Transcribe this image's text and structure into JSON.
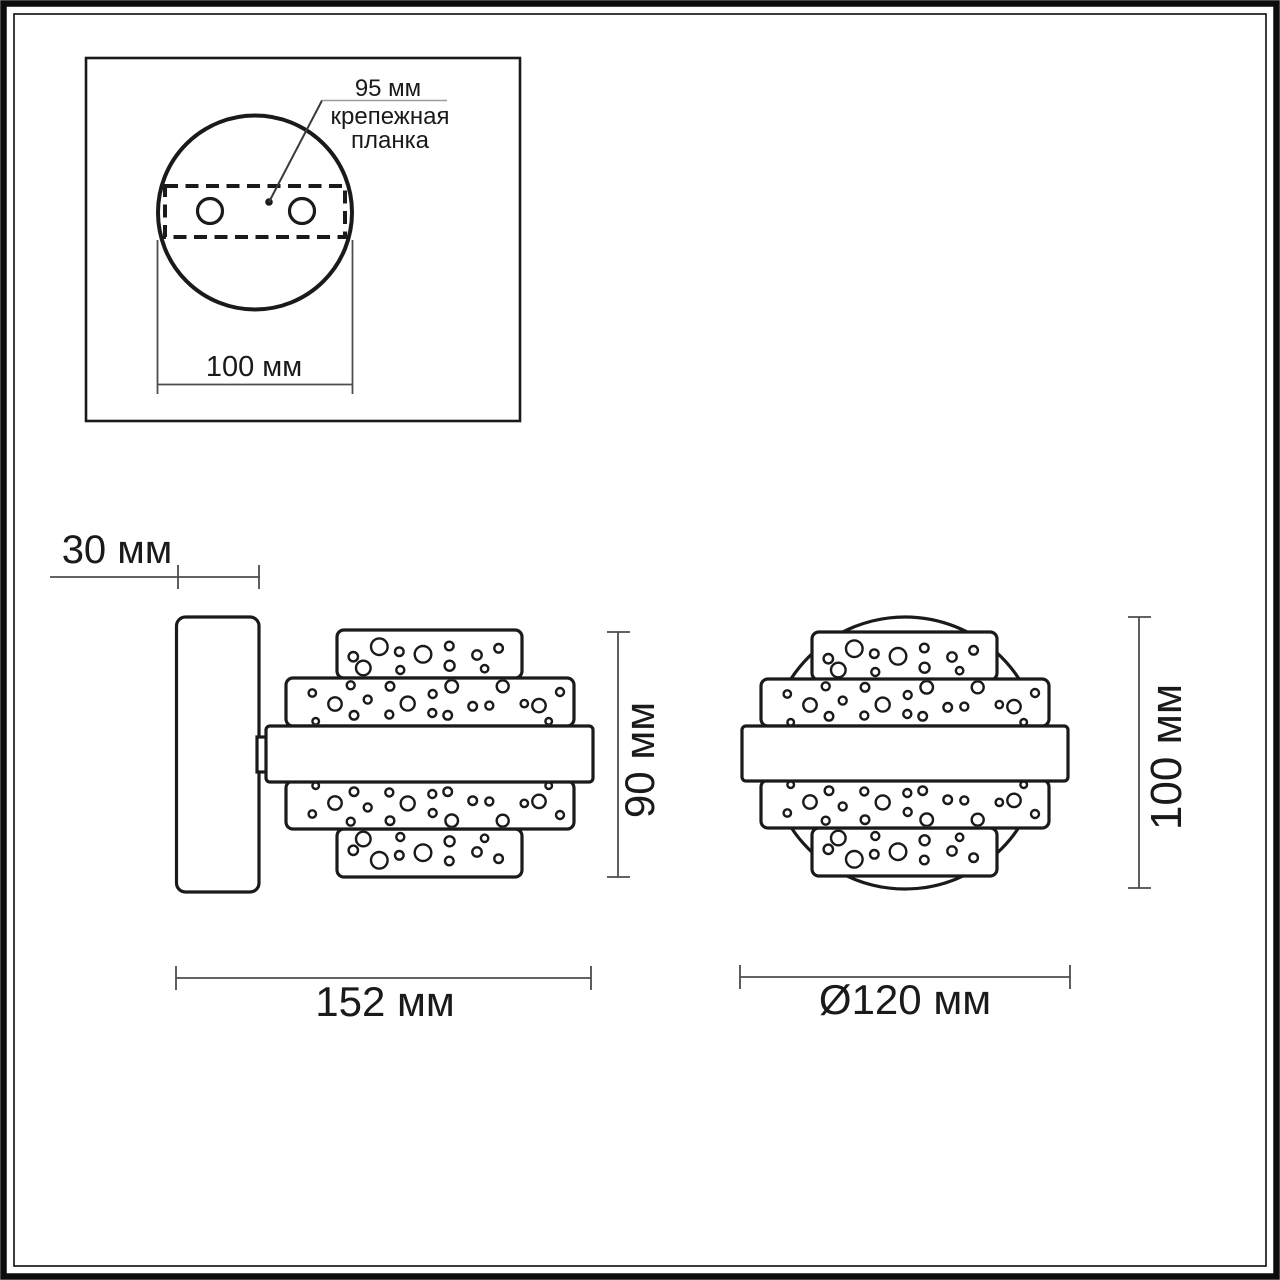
{
  "colors": {
    "ink": "#1a1a1a",
    "dim_line": "#4d4d4d",
    "leader_line": "#9a9a9a",
    "background": "#ffffff"
  },
  "inset": {
    "spacing_label": "95 мм",
    "bracket_line1": "крепежная",
    "bracket_line2": "планка",
    "width_label": "100 мм"
  },
  "side_view": {
    "wall_offset_label": "30 мм",
    "height_label": "90 мм",
    "depth_label": "152 мм"
  },
  "front_view": {
    "height_label": "100 мм",
    "diameter_label": "Ø120 мм"
  },
  "bubble_patterns": {
    "narrow": [
      [
        16.3,
        26.7,
        4.7
      ],
      [
        26.3,
        38.0,
        7.3
      ],
      [
        42.3,
        16.7,
        8.3
      ],
      [
        62.3,
        21.7,
        4.3
      ],
      [
        63.3,
        40.0,
        4.0
      ],
      [
        86.0,
        24.3,
        8.3
      ],
      [
        112.3,
        16.0,
        4.3
      ],
      [
        112.6,
        35.7,
        5.0
      ],
      [
        140.0,
        25.0,
        4.7
      ],
      [
        147.6,
        38.7,
        3.7
      ],
      [
        161.6,
        18.3,
        4.3
      ]
    ],
    "wide": [
      [
        26.3,
        15.0,
        3.7
      ],
      [
        49.0,
        26.0,
        6.7
      ],
      [
        64.7,
        7.3,
        4.0
      ],
      [
        68.0,
        37.3,
        4.3
      ],
      [
        81.7,
        21.6,
        4.0
      ],
      [
        104.0,
        8.3,
        4.3
      ],
      [
        103.3,
        36.6,
        4.0
      ],
      [
        121.7,
        25.6,
        7.0
      ],
      [
        146.7,
        16.0,
        4.0
      ],
      [
        146.3,
        35.0,
        4.0
      ],
      [
        165.7,
        8.3,
        6.3
      ],
      [
        161.7,
        37.3,
        4.3
      ],
      [
        186.7,
        28.3,
        4.3
      ],
      [
        203.3,
        27.6,
        4.0
      ],
      [
        216.7,
        8.3,
        6.0
      ],
      [
        238.3,
        25.6,
        3.7
      ],
      [
        253.0,
        27.6,
        6.7
      ],
      [
        262.7,
        43.3,
        3.3
      ],
      [
        274.0,
        14.0,
        4.0
      ],
      [
        29.7,
        43.3,
        3.3
      ]
    ]
  }
}
